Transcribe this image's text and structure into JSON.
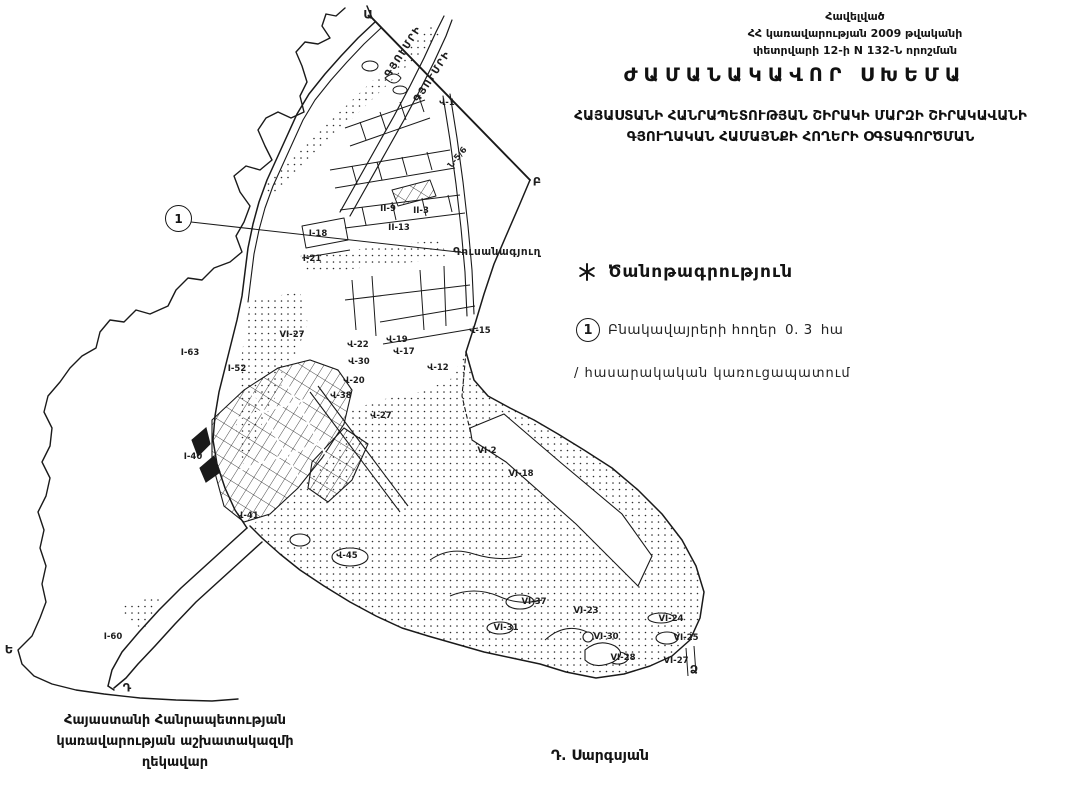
{
  "appendix": {
    "line1": "Հավելված",
    "line2": "ՀՀ կառավարության 2009 թվականի",
    "line3": "փետրվարի 12-ի N 132-Ն որոշման"
  },
  "title": {
    "text": "ԺԱՄԱՆԱԿԱՎՈՐ ՍԽԵՄԱ"
  },
  "subtitle": {
    "line1": "ՀԱՅԱՍՏԱՆԻ ՀԱՆՐԱՊԵՏՈՒԹՅԱՆ ՇԻՐԱԿԻ ՄԱՐԶԻ ՇԻՐԱԿԱՎԱՆԻ",
    "line2": "ԳՅՈՒՂԱԿԱՆ ՀԱՄԱՅՆՔԻ ՀՈՂԵՐԻ ՕԳՏԱԳՈՐԾՄԱՆ"
  },
  "legend": {
    "note_marker_icon": "asterisk-star",
    "note_title": "Ծանոթագրություն",
    "item1": {
      "marker": "1",
      "label": "Բնակավայրերի հողեր",
      "value": "0. 3",
      "unit": "հա"
    },
    "item2": {
      "label": "/ հասարակական կառուցապատում"
    }
  },
  "footer": {
    "line1": "Հայաստանի Հանրապետության",
    "line2": "կառավարության աշխատակազմի",
    "line3": "ղեկավար",
    "signature": "Դ. Սարգսյան"
  },
  "map": {
    "callout": {
      "marker": "1"
    },
    "road_labels": [
      {
        "t": "ԳՅՈՒՄՐԻ",
        "x": 404,
        "y": 52,
        "r": -57
      },
      {
        "t": "ԳՅՈՒՄՐԻ",
        "x": 433,
        "y": 77,
        "r": -57
      }
    ],
    "place_label": {
      "t": "Գուսանագյուղ",
      "x": 497,
      "y": 252
    },
    "boundary_letters": [
      {
        "t": "Ա",
        "x": 368,
        "y": 15
      },
      {
        "t": "Բ",
        "x": 537,
        "y": 182
      },
      {
        "t": "Ե",
        "x": 9,
        "y": 650
      },
      {
        "t": "Դ",
        "x": 127,
        "y": 688
      },
      {
        "t": "Ձ",
        "x": 694,
        "y": 670
      }
    ],
    "parcel_labels": [
      {
        "t": "Վ-1",
        "x": 447,
        "y": 103
      },
      {
        "t": "Ն-5/6",
        "x": 458,
        "y": 158,
        "r": -50
      },
      {
        "t": "II-9",
        "x": 388,
        "y": 209
      },
      {
        "t": "II-3",
        "x": 421,
        "y": 211
      },
      {
        "t": "II-13",
        "x": 399,
        "y": 228
      },
      {
        "t": "I-18",
        "x": 318,
        "y": 234
      },
      {
        "t": "I-21",
        "x": 312,
        "y": 259
      },
      {
        "t": "Վ-15",
        "x": 480,
        "y": 331
      },
      {
        "t": "VI-27",
        "x": 292,
        "y": 335
      },
      {
        "t": "I-63",
        "x": 190,
        "y": 353
      },
      {
        "t": "I-52",
        "x": 237,
        "y": 369
      },
      {
        "t": "Վ-22",
        "x": 358,
        "y": 345
      },
      {
        "t": "Վ-19",
        "x": 397,
        "y": 340
      },
      {
        "t": "Վ-17",
        "x": 404,
        "y": 352
      },
      {
        "t": "Վ-30",
        "x": 359,
        "y": 362
      },
      {
        "t": "Վ-12",
        "x": 438,
        "y": 368
      },
      {
        "t": "Վ-20",
        "x": 354,
        "y": 381
      },
      {
        "t": "Վ-38",
        "x": 341,
        "y": 396
      },
      {
        "t": "Վ-27",
        "x": 381,
        "y": 416
      },
      {
        "t": "I-40",
        "x": 193,
        "y": 457
      },
      {
        "t": "Վ-41",
        "x": 248,
        "y": 516
      },
      {
        "t": "VI-2",
        "x": 487,
        "y": 451
      },
      {
        "t": "VI-18",
        "x": 521,
        "y": 474
      },
      {
        "t": "Վ-45",
        "x": 347,
        "y": 556
      },
      {
        "t": "VI-37",
        "x": 534,
        "y": 602
      },
      {
        "t": "VI-23",
        "x": 586,
        "y": 611
      },
      {
        "t": "VI-24",
        "x": 671,
        "y": 619
      },
      {
        "t": "VI-31",
        "x": 506,
        "y": 628
      },
      {
        "t": "VI-30",
        "x": 606,
        "y": 637
      },
      {
        "t": "VI-25",
        "x": 686,
        "y": 638
      },
      {
        "t": "VI-28",
        "x": 623,
        "y": 658
      },
      {
        "t": "VI-27",
        "x": 676,
        "y": 661
      },
      {
        "t": "I-60",
        "x": 113,
        "y": 637
      }
    ]
  }
}
